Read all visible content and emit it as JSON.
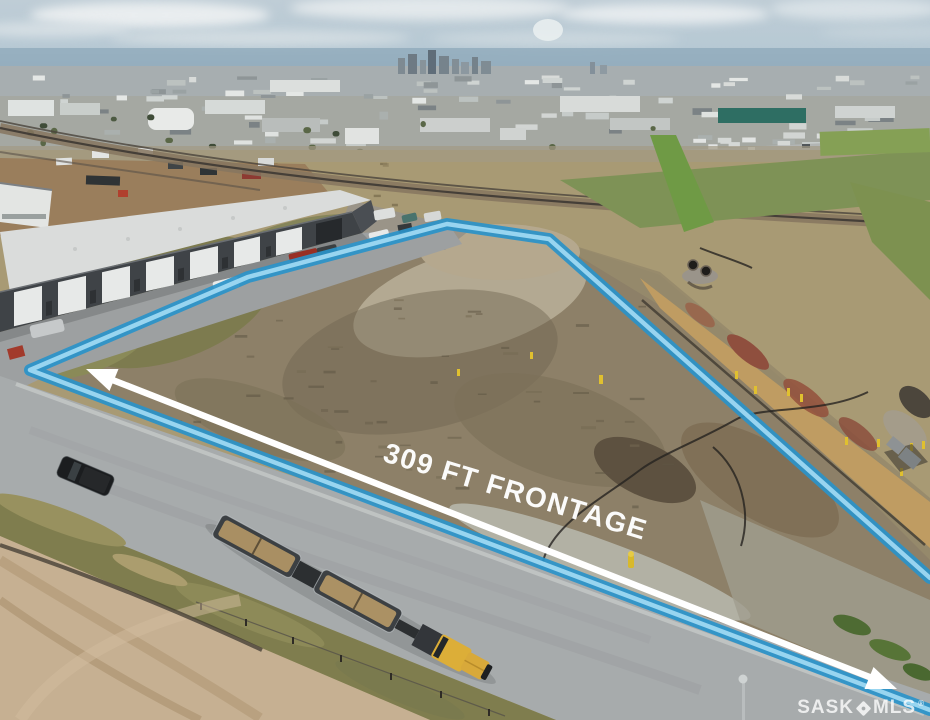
{
  "annotations": {
    "frontage_label": "309 FT FRONTAGE"
  },
  "watermark": {
    "prefix": "SASK",
    "suffix": "MLS",
    "registered": "®"
  },
  "colors": {
    "boundary_outer": "#2a93c9",
    "boundary_inner": "#9ed8f2",
    "arrow": "#ffffff",
    "label_text": "#ffffff",
    "watermark_text": "rgba(255,255,255,0.78)",
    "sky": "#b4c9d4",
    "road": "#a7abac",
    "lot_dirt": "#8d8068",
    "building_wall": "#3f4347",
    "building_roof": "#dadcdb",
    "truck_yellow": "#dcae38",
    "grass_verge": "#7f7d4e",
    "ridge_grass": "#bf9c62",
    "bottom_dirt": "#c6b092"
  }
}
